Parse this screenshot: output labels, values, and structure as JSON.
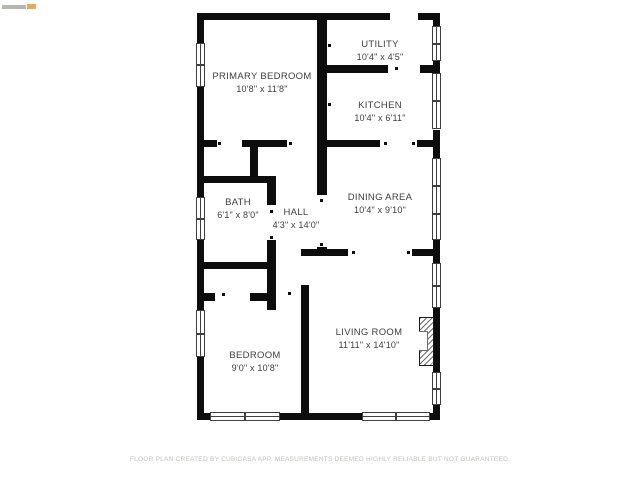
{
  "rooms": [
    {
      "name": "PRIMARY BEDROOM",
      "dims": "10'8\" x 11'8\""
    },
    {
      "name": "UTILITY",
      "dims": "10'4\" x 4'5\""
    },
    {
      "name": "KITCHEN",
      "dims": "10'4\" x 6'11\""
    },
    {
      "name": "BATH",
      "dims": "6'1\" x 8'0\""
    },
    {
      "name": "HALL",
      "dims": "4'3\" x 14'0\""
    },
    {
      "name": "DINING AREA",
      "dims": "10'4\" x 9'10\""
    },
    {
      "name": "BEDROOM",
      "dims": "9'0\" x 10'8\""
    },
    {
      "name": "LIVING ROOM",
      "dims": "11'11\" x 14'10\""
    }
  ],
  "footer": {
    "disclaimer": "FLOOR PLAN CREATED BY CUBICASA APP. MEASUREMENTS DEEMED HIGHLY RELIABLE BUT NOT GUARANTEED."
  },
  "colors": {
    "wall": "#0d0d0d",
    "label_text": "#3e3e3e",
    "footer_text": "#c6beb4",
    "watermark_gray": "#a39b93",
    "watermark_orange": "#e1a33f"
  }
}
